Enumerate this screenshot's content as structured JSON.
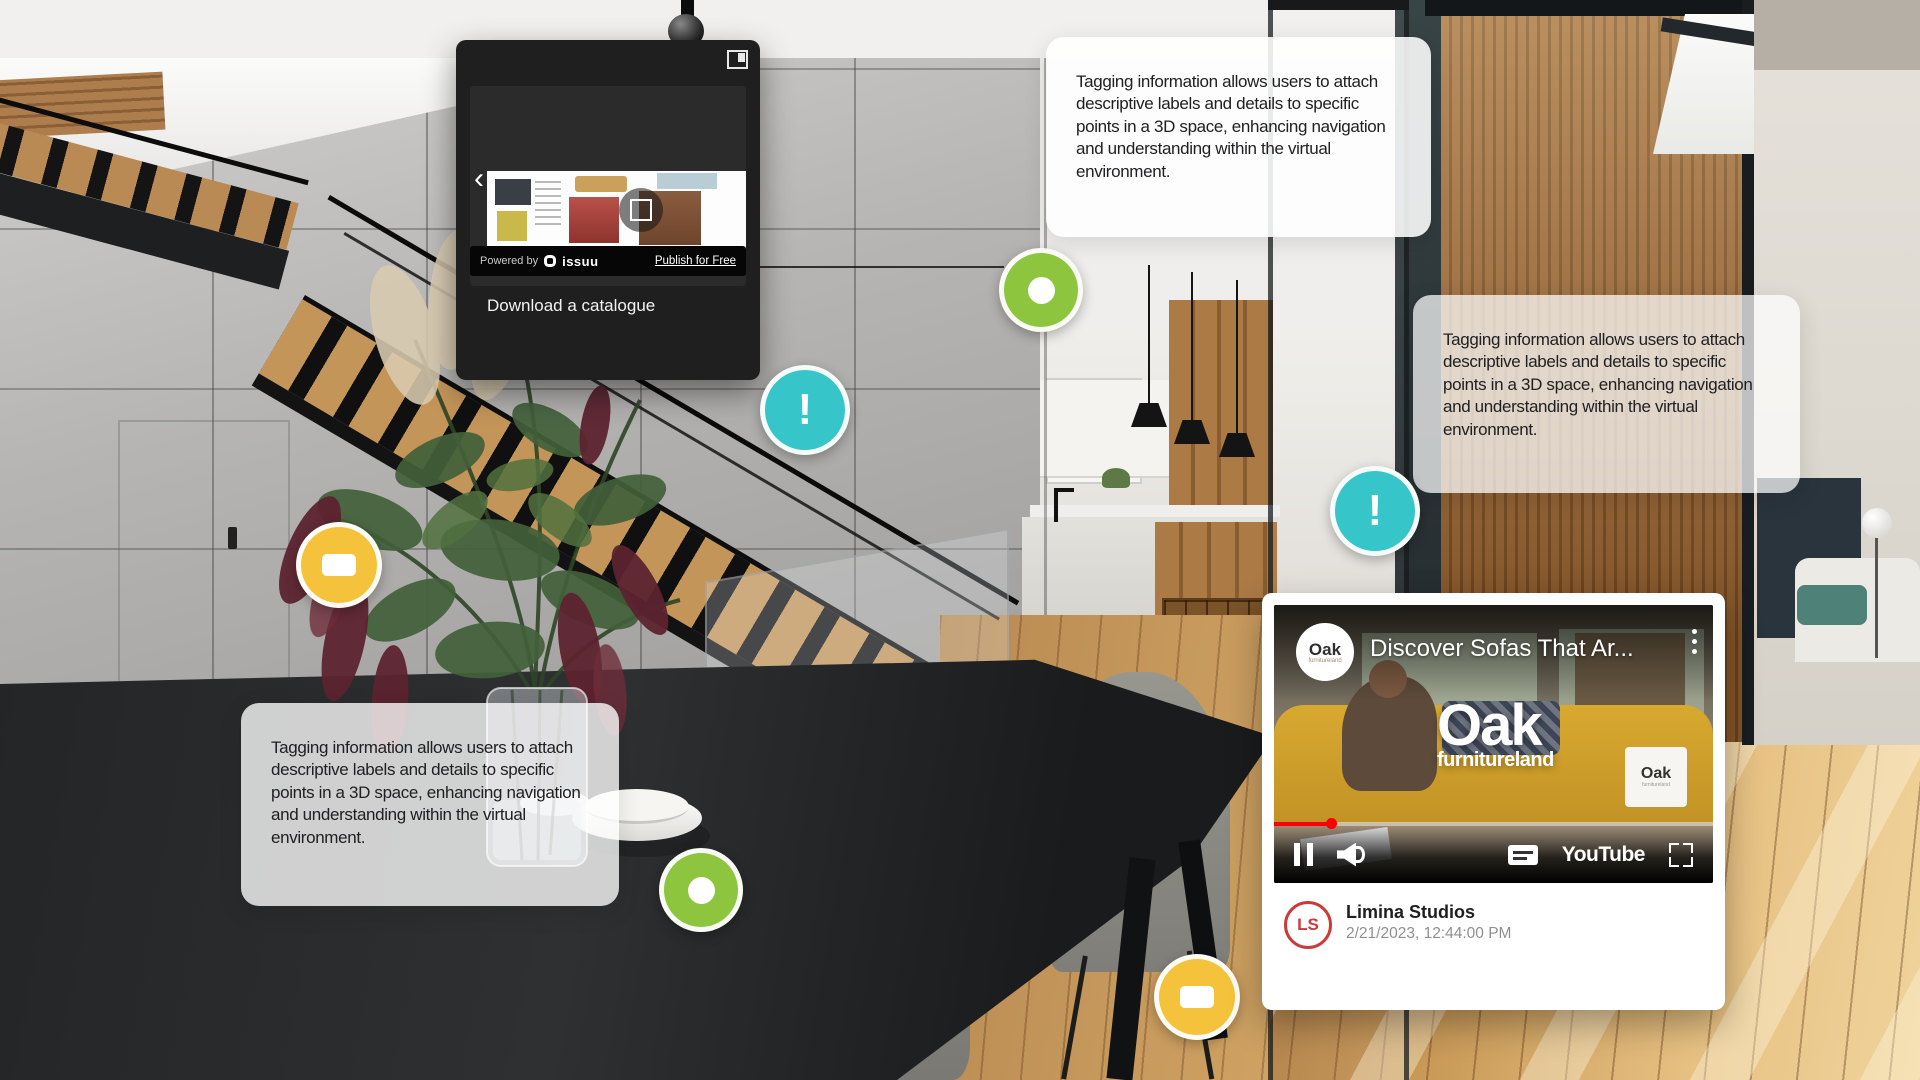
{
  "app": {
    "name": "3D Virtual Tour Viewer"
  },
  "colors": {
    "marker-green": "#8dc63e",
    "marker-teal": "#36c5c8",
    "marker-yellow": "#f5c33b",
    "accent-red": "#cc3a3a",
    "progress-red": "#ff0000"
  },
  "tooltip": {
    "text": "Tagging information allows users to attach descriptive labels and details to specific points in a 3D space, enhancing navigation and understanding within the virtual environment."
  },
  "catalogue_widget": {
    "caption": "Download a catalogue",
    "powered_by": "Powered by",
    "brand": "issuu",
    "publish_link": "Publish for Free"
  },
  "markers": {
    "info_glyph": "!",
    "types": [
      "media-ring",
      "info-exclamation",
      "comment-bubble"
    ]
  },
  "video_card": {
    "title": "Discover Sofas That Ar...",
    "channel": "Oak",
    "channel_sub": "furnitureland",
    "brand_main": "Oak",
    "brand_sub": "furnitureland",
    "youtube_label": "YouTube",
    "author": "Limina Studios",
    "author_initials": "LS",
    "timestamp": "2/21/2023, 12:44:00 PM"
  },
  "icons": {
    "expand": "open-panel-icon",
    "prev": "chevron-left-icon",
    "fullscreen": "fullscreen-icon",
    "menu": "kebab-menu-icon",
    "pause": "pause-icon",
    "volume": "volume-icon",
    "captions": "closed-captions-icon",
    "comment": "speech-bubble-icon",
    "info": "exclamation-icon",
    "media": "ring-icon"
  }
}
